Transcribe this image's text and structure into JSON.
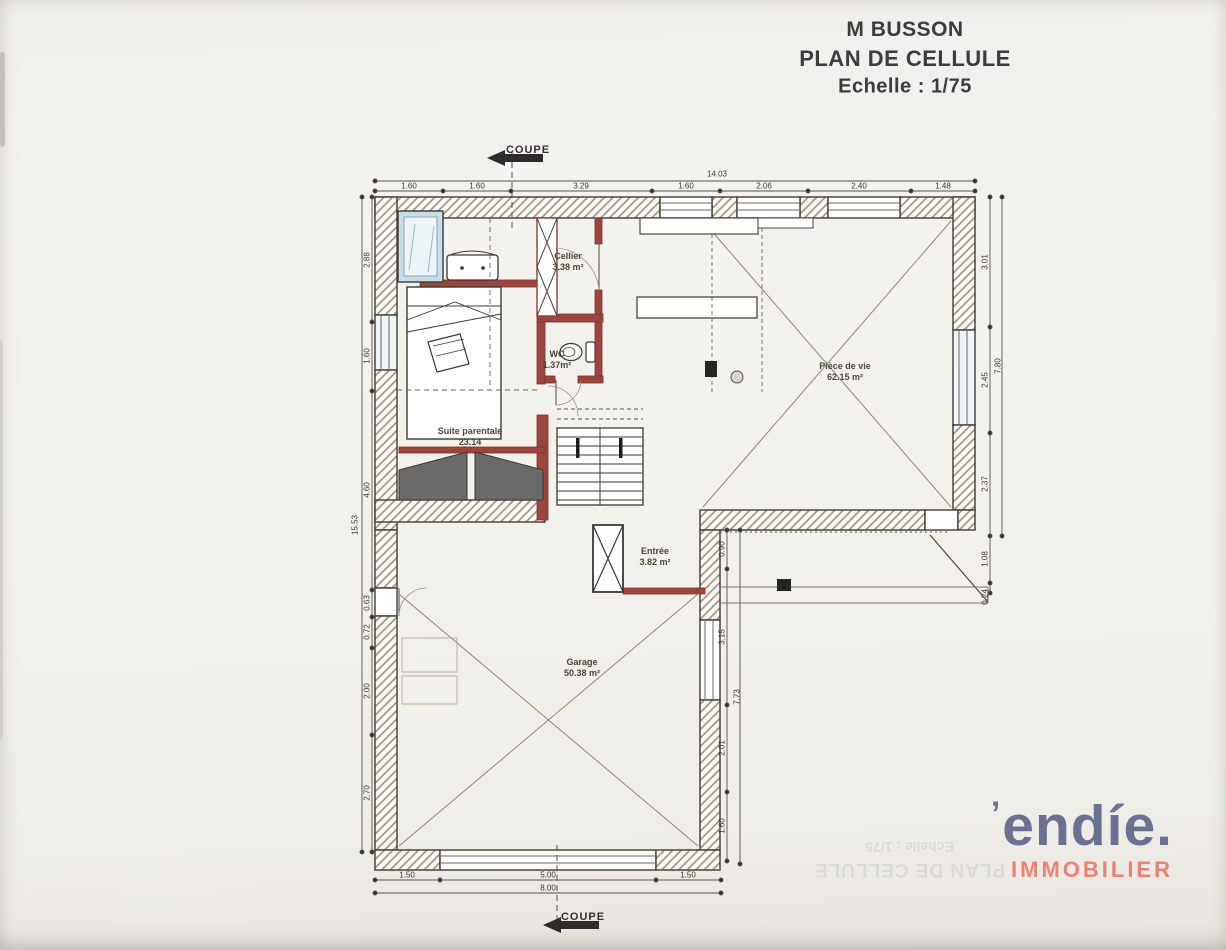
{
  "title_block": {
    "line1": "M BUSSON",
    "line2": "PLAN DE CELLULE",
    "line3": "Echelle : 1/75"
  },
  "section_marks": {
    "top": "COUPE",
    "bottom": "COUPE"
  },
  "rooms": [
    {
      "name": "Cellier",
      "area": "3.38 m²"
    },
    {
      "name": "WC",
      "area": "1.37m²"
    },
    {
      "name": "Suite parentale",
      "area": "23.14"
    },
    {
      "name": "Pièce de vie",
      "area": "62.15 m²"
    },
    {
      "name": "Entrée",
      "area": "3.82 m²"
    },
    {
      "name": "Garage",
      "area": "50.38 m²"
    }
  ],
  "dimensions": {
    "top_total": "14.03",
    "top": [
      "1.60",
      "1.60",
      "3.29",
      "1.60",
      "2.06",
      "2.40",
      "1.48"
    ],
    "left_total": "15.53",
    "left": [
      "2.88",
      "1.60",
      "4.60",
      "0.63",
      "0.72",
      "2.00",
      "2.70"
    ],
    "right_total": "7.80",
    "right": [
      "3.01",
      "2.45",
      "2.37",
      "1.08",
      "0.24"
    ],
    "garage_total": "7.73",
    "garage_right": [
      "0.90",
      "3.15",
      "2.01",
      "1.60"
    ],
    "bottom_total": "8.00",
    "bottom": [
      "1.50",
      "5.00",
      "1.50"
    ]
  },
  "logo": {
    "mark": "’",
    "brand": "endíe.",
    "tagline": "IMMOBILIER",
    "brand_color": "#6b7190",
    "tagline_color": "#ee8173"
  },
  "scan_ghost": {
    "line1": "PLAN DE CELLULE",
    "line2": "Echelle : 1/75"
  },
  "colors": {
    "paper": "#f3f1ed",
    "linework": "#4c463f",
    "wall_accent": "#9a453d",
    "window": "#c7dde8",
    "hatch": "#9b8d80"
  }
}
